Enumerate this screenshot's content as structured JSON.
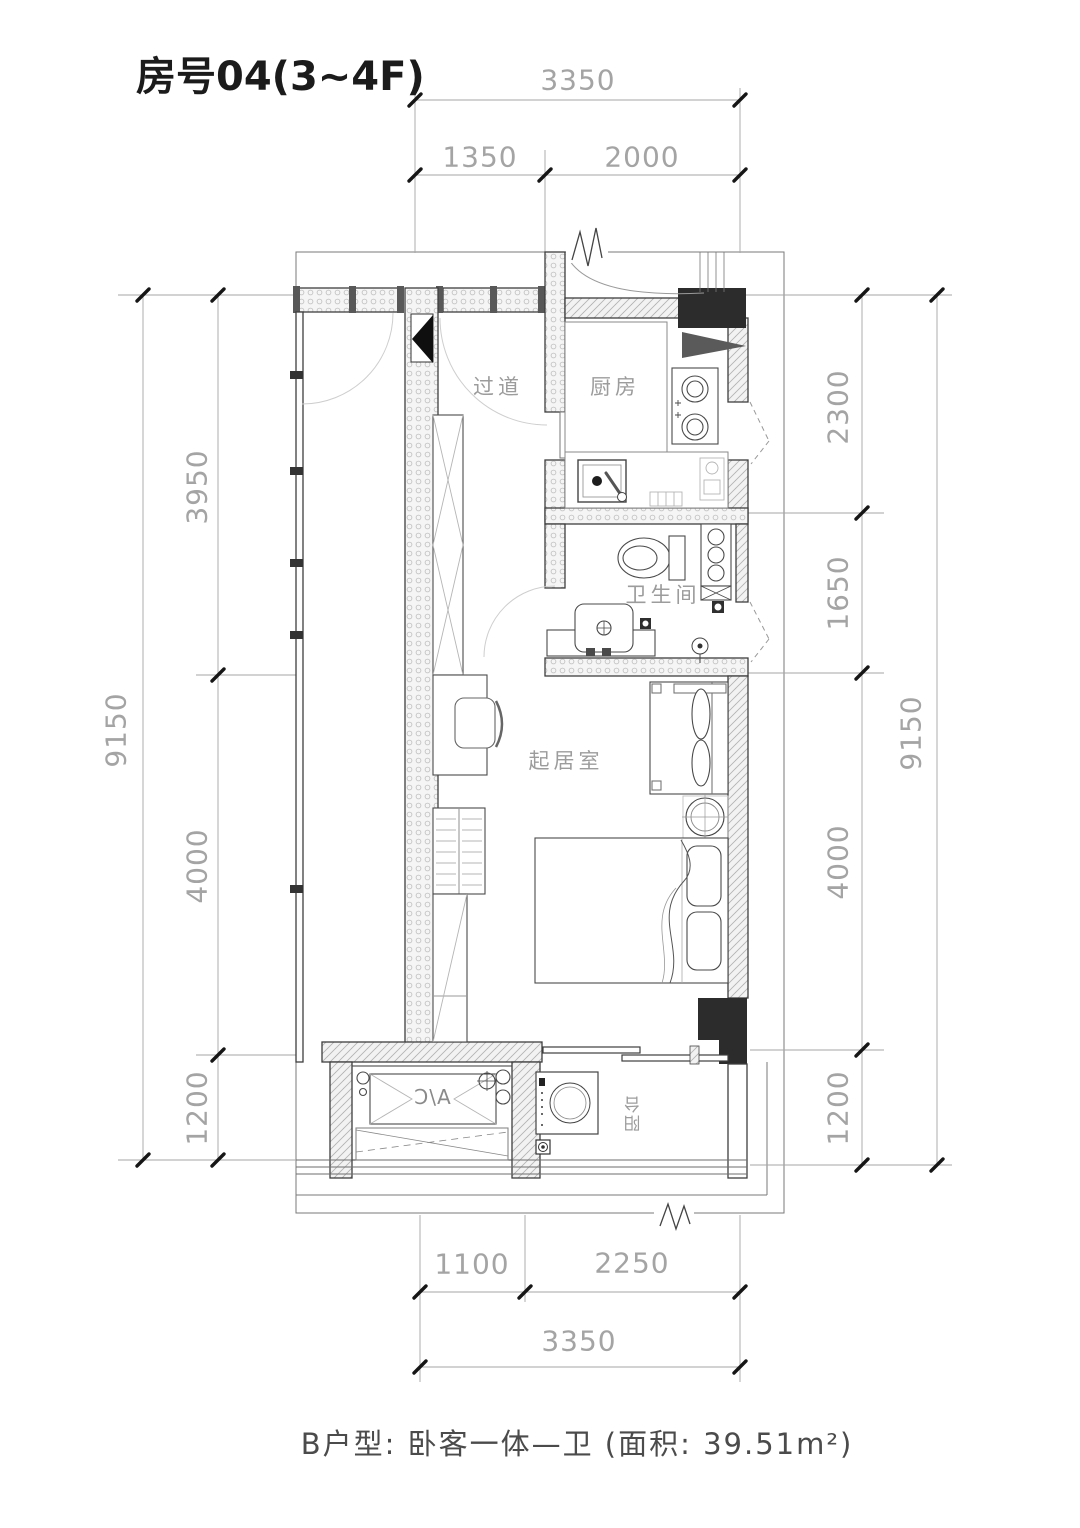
{
  "title": "房号04(3~4F)",
  "caption": "B户型: 卧客一体—卫 (面积: 39.51m²)",
  "rooms": {
    "corridor": "过道",
    "kitchen": "厨房",
    "bathroom": "卫生间",
    "living": "起居室",
    "balcony": "阳台",
    "ac_unit": "A/C"
  },
  "dims": {
    "top": {
      "overall": "3350",
      "segments": [
        "1350",
        "2000"
      ]
    },
    "left": {
      "overall": "9150",
      "segments": [
        "3950",
        "4000",
        "1200"
      ]
    },
    "right": {
      "overall": "9150",
      "segments": [
        "2300",
        "1650",
        "4000",
        "1200"
      ]
    },
    "bottom": {
      "overall": "3350",
      "segments": [
        "1100",
        "2250"
      ]
    }
  },
  "colors": {
    "background": "#ffffff",
    "wall_line": "#3e3e3e",
    "solid_column": "#2c2c2c",
    "dimension_line": "#a6a6a6",
    "dimension_text": "#a4a4a4",
    "room_text": "#9c9c9c",
    "title_text": "#1b1b1b"
  }
}
